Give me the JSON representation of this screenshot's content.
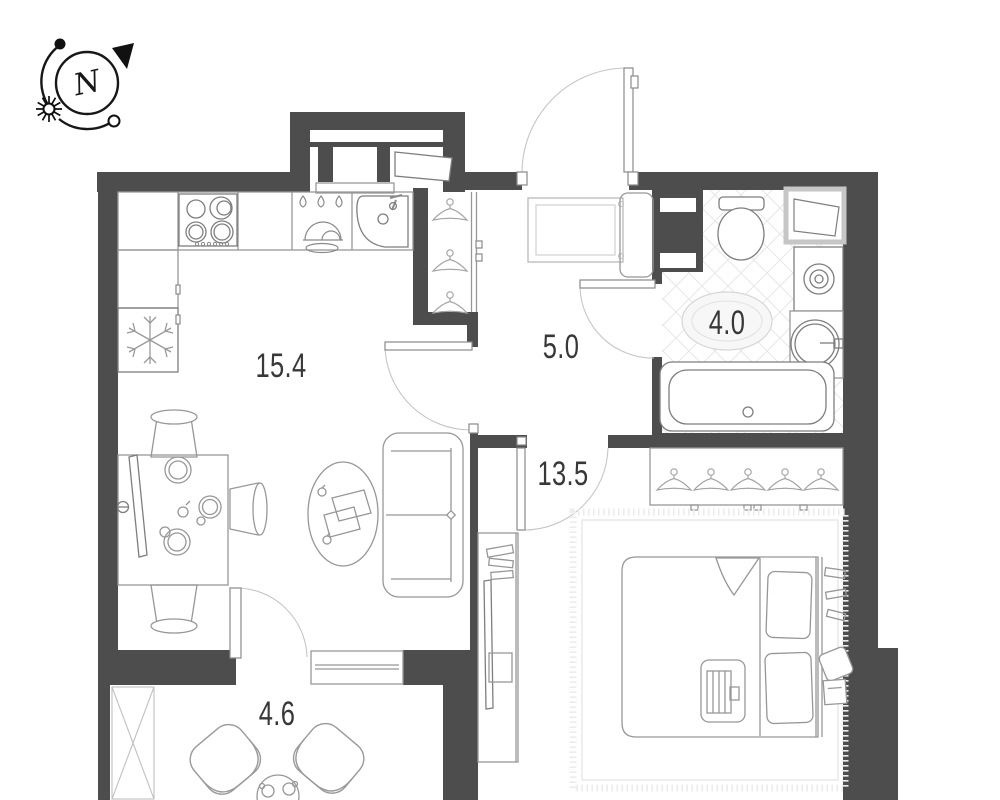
{
  "plan": {
    "title": "apartment-floor-plan",
    "compass": {
      "letter": "N"
    },
    "rooms": [
      {
        "name": "kitchen-living-room",
        "area": "15.4"
      },
      {
        "name": "hallway",
        "area": "5.0"
      },
      {
        "name": "bathroom",
        "area": "4.0"
      },
      {
        "name": "bedroom",
        "area": "13.5"
      },
      {
        "name": "balcony",
        "area": "4.6"
      }
    ],
    "symbols": {
      "compass-north-icon": "circle with N, sun and orbit arc",
      "fridge-icon": "snowflake",
      "stove-icon": "four burners",
      "dishwasher-icon": "three water drops with dish",
      "wardrobe-icon": "coat hangers",
      "washing-machine-icon": "square with spiral"
    },
    "colors": {
      "wall": "#4d4d4d",
      "furniture_line": "#979797",
      "door_arc": "#c6c6c6",
      "label_text": "#383838",
      "tile_line": "#e7e7e7"
    }
  }
}
